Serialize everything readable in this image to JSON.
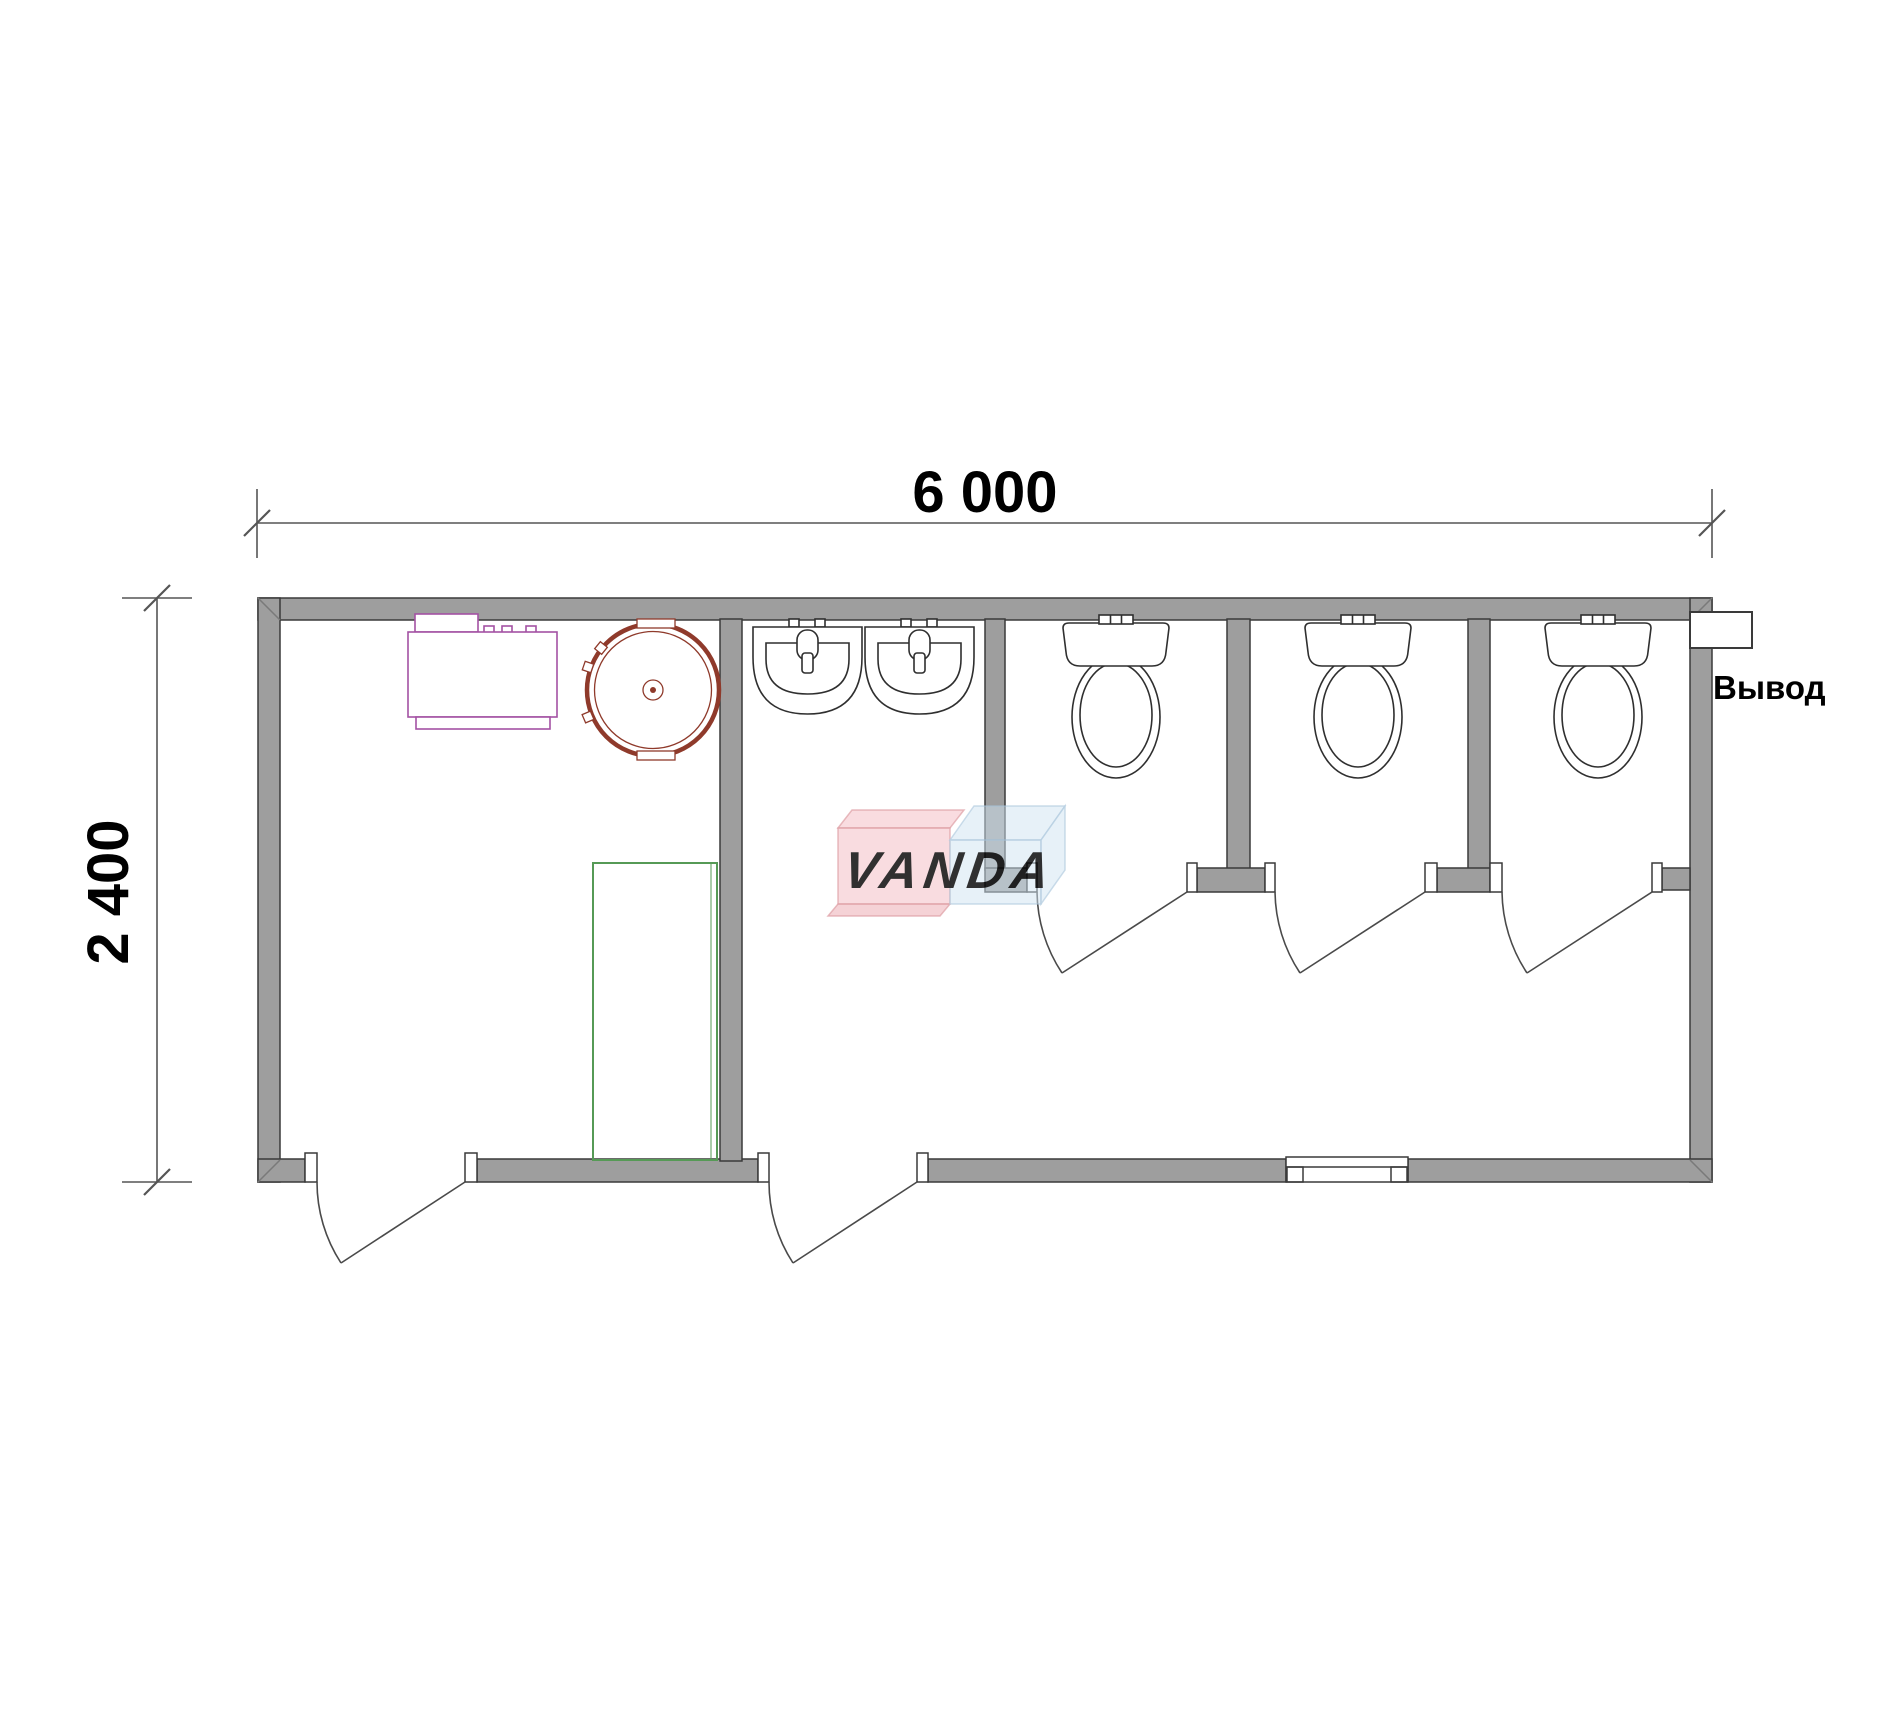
{
  "dimensions": {
    "width_label": "6 000",
    "height_label": "2 400"
  },
  "annotations": {
    "outlet_label": "Вывод"
  },
  "watermark": {
    "text": "VANDA"
  },
  "colors": {
    "wall_fill": "#9e9e9e",
    "wall_outline": "#3a3a3a",
    "fixture_line": "#2f2f2f",
    "door_line": "#4a4a4a",
    "dimension_line": "#555555",
    "text": "#000000",
    "water_heater_outline": "#a352a3",
    "water_tank_outline": "#8f3a2b",
    "shower_tray_outline": "#569a56",
    "watermark_pink": "#f3bac1",
    "watermark_pink_edge": "#e2939b",
    "watermark_blue": "#cfe2f0",
    "watermark_blue_edge": "#a8c4dc",
    "watermark_text": "#ffffff"
  },
  "fixtures": {
    "water_heater": "water-heater",
    "water_tank": "round-water-tank",
    "shower_tray": "shower-tray",
    "washbasins_count": 2,
    "toilets_count": 3,
    "doors_count": 5,
    "window_count": 1
  }
}
